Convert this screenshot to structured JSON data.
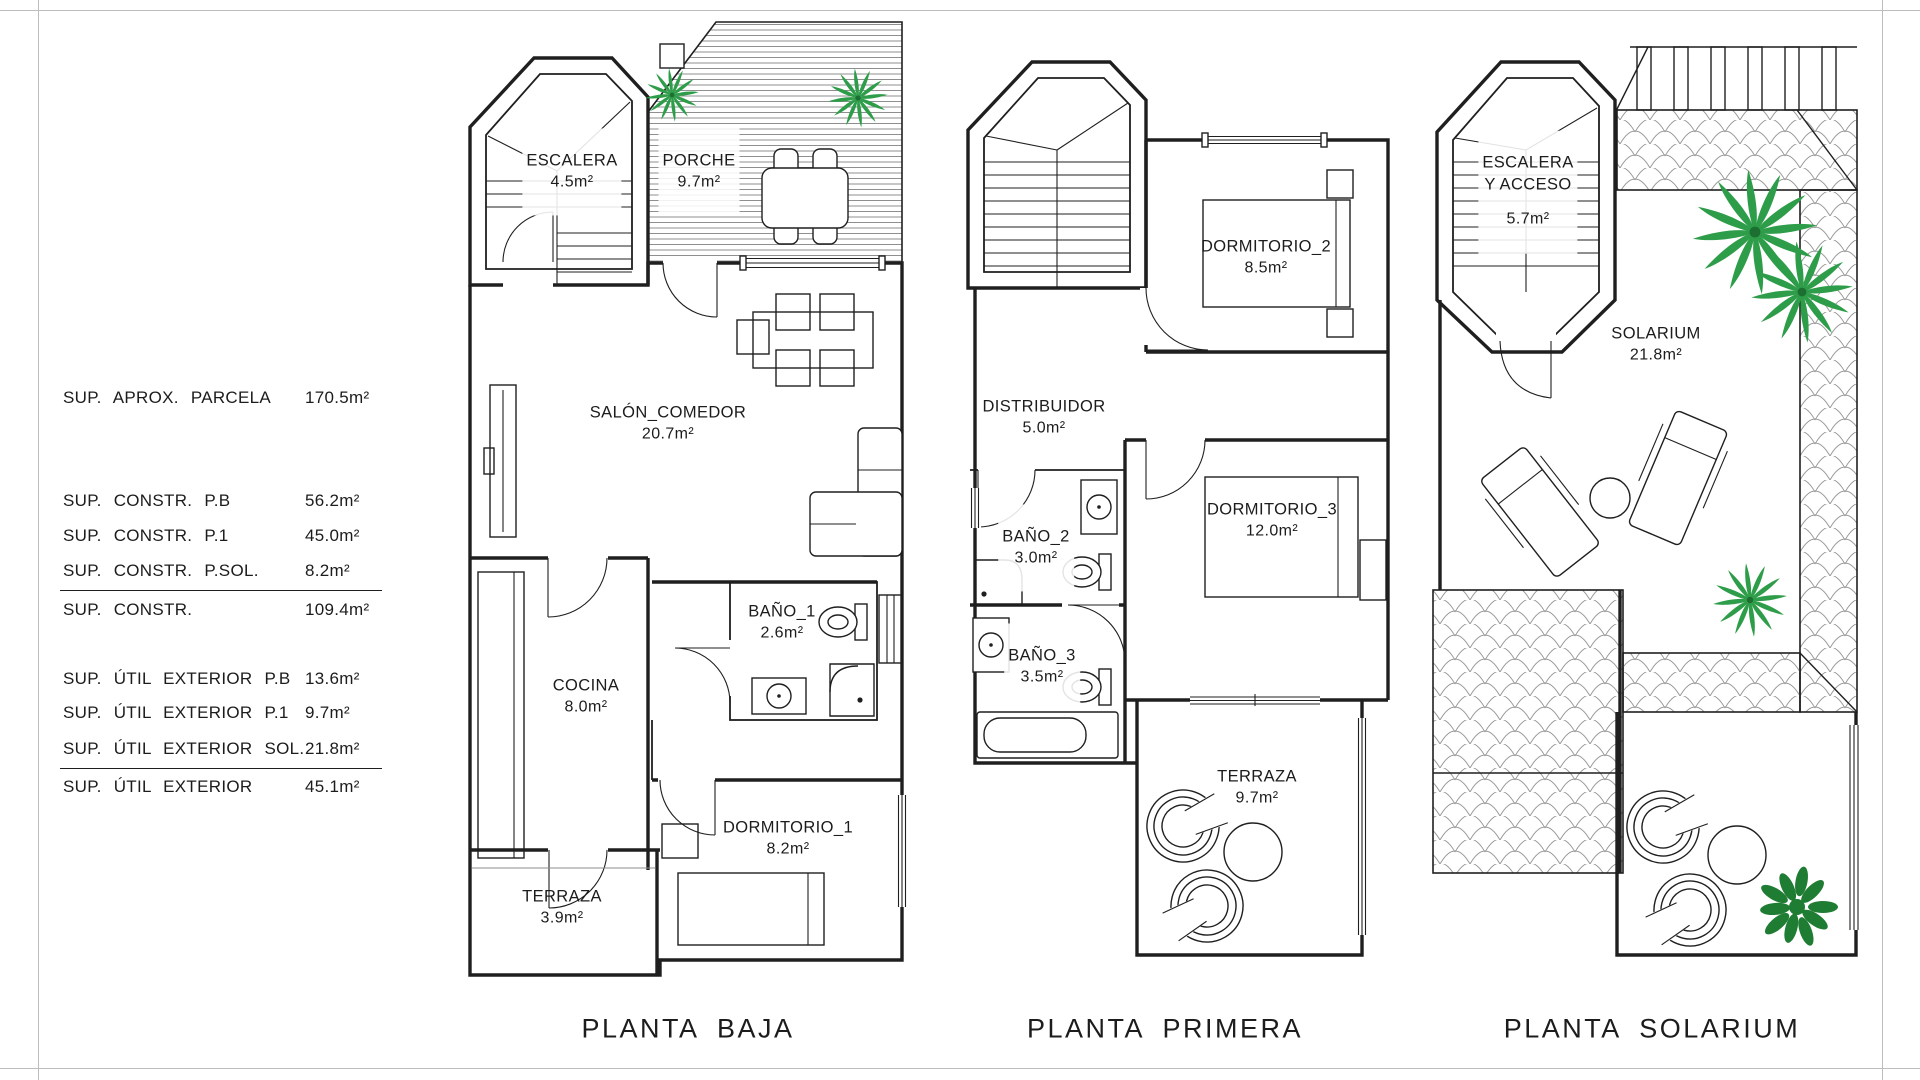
{
  "sheet": {
    "background": "#ffffff",
    "frame_color": "#bdbdbd"
  },
  "summary_table": {
    "rows": [
      {
        "label": "SUP.  APROX.  PARCELA",
        "value": "170.5m²"
      },
      {
        "label": "SUP.  CONSTR.  P.B",
        "value": "56.2m²"
      },
      {
        "label": "SUP.  CONSTR.  P.1",
        "value": "45.0m²"
      },
      {
        "label": "SUP.  CONSTR.  P.SOL.",
        "value": "8.2m²"
      },
      {
        "label": "SUP.  CONSTR.",
        "value": "109.4m²"
      },
      {
        "label": "SUP.  ÚTIL  EXTERIOR  P.B",
        "value": "13.6m²"
      },
      {
        "label": "SUP.  ÚTIL  EXTERIOR  P.1",
        "value": "9.7m²"
      },
      {
        "label": "SUP.  ÚTIL  EXTERIOR  SOL.",
        "value": "21.8m²"
      },
      {
        "label": "SUP.  ÚTIL  EXTERIOR",
        "value": "45.1m²"
      }
    ]
  },
  "plans": [
    {
      "title": "PLANTA  BAJA",
      "rooms": [
        {
          "name": "ESCALERA",
          "area": "4.5m²"
        },
        {
          "name": "PORCHE",
          "area": "9.7m²"
        },
        {
          "name": "SALÓN_COMEDOR",
          "area": "20.7m²"
        },
        {
          "name": "COCINA",
          "area": "8.0m²"
        },
        {
          "name": "BAÑO_1",
          "area": "2.6m²"
        },
        {
          "name": "DORMITORIO_1",
          "area": "8.2m²"
        },
        {
          "name": "TERRAZA",
          "area": "3.9m²"
        }
      ]
    },
    {
      "title": "PLANTA  PRIMERA",
      "rooms": [
        {
          "name": "DORMITORIO_2",
          "area": "8.5m²"
        },
        {
          "name": "DISTRIBUIDOR",
          "area": "5.0m²"
        },
        {
          "name": "BAÑO_2",
          "area": "3.0m²"
        },
        {
          "name": "DORMITORIO_3",
          "area": "12.0m²"
        },
        {
          "name": "BAÑO_3",
          "area": "3.5m²"
        },
        {
          "name": "TERRAZA",
          "area": "9.7m²"
        }
      ]
    },
    {
      "title": "PLANTA  SOLARIUM",
      "rooms": [
        {
          "name": "ESCALERA\nY  ACCESO",
          "area": "5.7m²"
        },
        {
          "name": "SOLARIUM",
          "area": "21.8m²"
        }
      ]
    }
  ],
  "colors": {
    "wall": "#1f1f1f",
    "hatch_gray": "#9a9a9a",
    "plant_green": "#2e9d49",
    "bush_green": "#1f7c33"
  }
}
